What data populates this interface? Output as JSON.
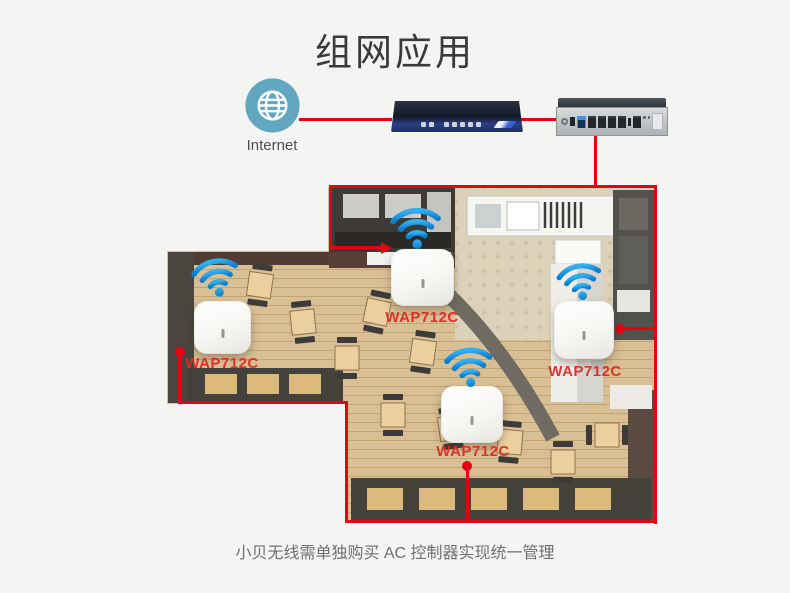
{
  "header": {
    "title": "组网应用"
  },
  "internet": {
    "label": "Internet",
    "icon": "globe-icon"
  },
  "devices": {
    "ac_controller_icon": "ac-controller-device",
    "router_icon": "gateway-router-device"
  },
  "access_points": [
    {
      "label": "WAP712C",
      "icon": "wifi-signal-icon"
    },
    {
      "label": "WAP712C",
      "icon": "wifi-signal-icon"
    },
    {
      "label": "WAP712C",
      "icon": "wifi-signal-icon"
    },
    {
      "label": "WAP712C",
      "icon": "wifi-signal-icon"
    }
  ],
  "footer": {
    "caption": "小贝无线需单独购买 AC 控制器实现统一管理"
  },
  "colors": {
    "connection_line_red": "#e60012",
    "ap_label_red": "#de2a22",
    "wifi_blue_top": "#35aeee",
    "wifi_blue_bottom": "#0b7ecd",
    "internet_circle_teal": "#61a7bf",
    "background": "#f4f4f2"
  }
}
